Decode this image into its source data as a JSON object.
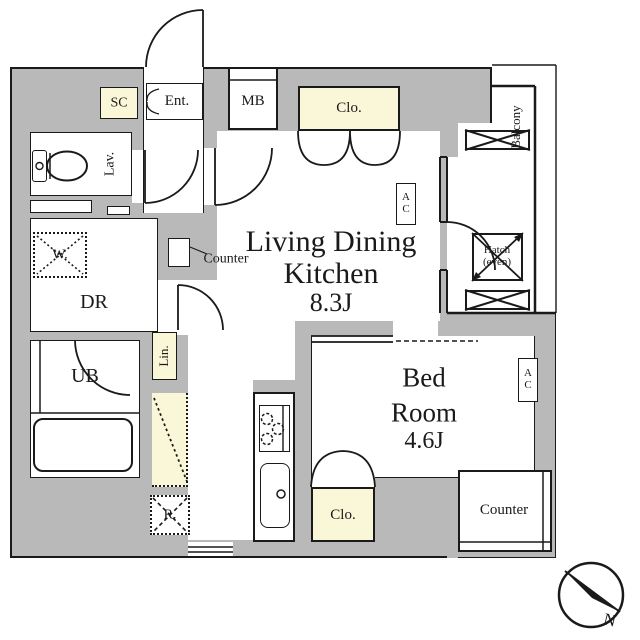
{
  "rooms": {
    "ldk": {
      "line1": "Living Dining",
      "line2": "Kitchen",
      "size": "8.3J"
    },
    "bedroom": {
      "line1": "Bed",
      "line2": "Room",
      "size": "4.6J"
    },
    "dressing_room": "DR",
    "unit_bath": "UB",
    "lavatory": "Lav.",
    "balcony": "Balcony",
    "entrance": "Ent."
  },
  "fixtures": {
    "shoe_cabinet": "SC",
    "meter_box": "MB",
    "closet_top": "Clo.",
    "closet_bedroom": "Clo.",
    "linen": "Lin.",
    "washer": "W.",
    "refrigerator": "R.",
    "counter_kitchen": "Counter",
    "counter_bedroom": "Counter",
    "hatch_line1": "Hatch",
    "hatch_line2": "(even)",
    "ac_line1": "A",
    "ac_line2": "C"
  },
  "compass": {
    "north": "N"
  },
  "colors": {
    "wall": "#b9b9b9",
    "accent": "#faf6d8",
    "line": "#1a1a1a"
  }
}
